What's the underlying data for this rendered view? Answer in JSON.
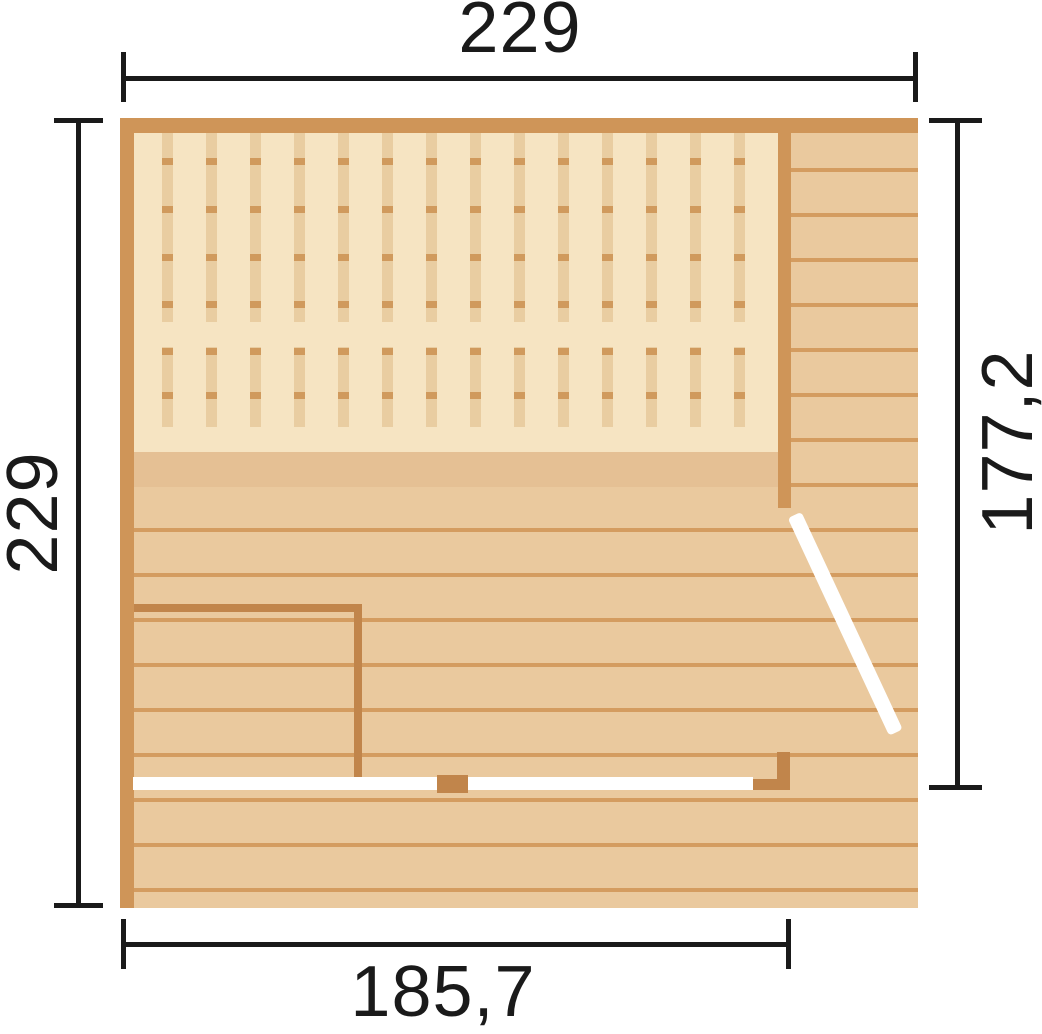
{
  "diagram": {
    "type": "sauna-floor-plan",
    "dimensions": {
      "top": "229",
      "left": "229",
      "right": "177,2",
      "bottom": "185,7"
    }
  },
  "colors": {
    "background": "#ffffff",
    "wall": "#cf9558",
    "wall_dark": "#c1854b",
    "floor": "#eac99e",
    "floor_line": "#d49c60",
    "floor_dark": "#e5c094",
    "bench_bg": "#f6e4c2",
    "bench_slat": "#e9cda1",
    "bench_tick": "#d09a5d",
    "glass": "#ffffff",
    "dimension": "#1a1a1a"
  }
}
